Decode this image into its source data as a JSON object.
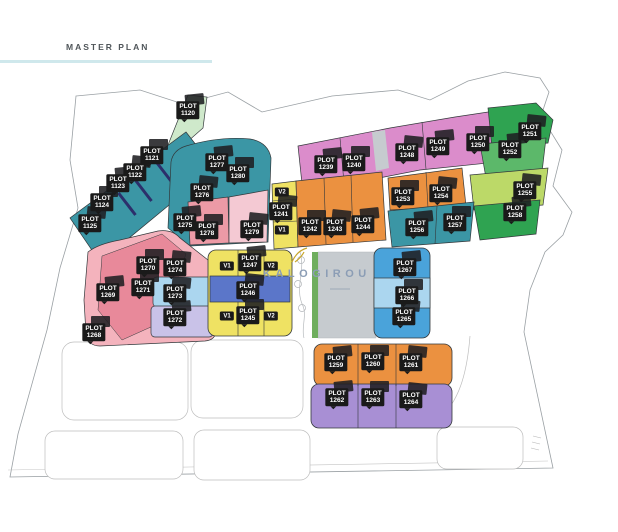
{
  "title": "MASTER PLAN",
  "brand": {
    "name": "KALOGIROU"
  },
  "colors": {
    "teal": "#3b96a5",
    "navyStripe": "#2c2f6b",
    "lightGreen": "#cfe9cb",
    "magenta": "#db8ccb",
    "pinkLight": "#f4c9d3",
    "pinkRose": "#ec9aa6",
    "pinkPale": "#f4b3bd",
    "pinkDeep": "#e8899a",
    "orange": "#eb9140",
    "yellow": "#efe263",
    "green": "#2fa351",
    "midGreen": "#5cb86a",
    "yellowGreen": "#bcd968",
    "greenStrip": "#6fae5e",
    "blue": "#5b76c9",
    "skyBlue": "#4aa3da",
    "paleBlue": "#abd6ef",
    "lavender": "#c9c2e8",
    "purple": "#a88fd4",
    "roadGray": "#c6cbcf",
    "gold": "#c8a62b",
    "brandText": "#8b9db5",
    "titleRule": "#cfe8ec",
    "labelBg": "#1a1a1a",
    "labelText": "#ffffff"
  },
  "plots": [
    {
      "kind": "plot",
      "label": "PLOT",
      "number": "1120",
      "x": 188,
      "y": 110,
      "area_color": "#cfe9cb"
    },
    {
      "kind": "plot",
      "label": "PLOT",
      "number": "1121",
      "x": 152,
      "y": 155,
      "area_color": "#3b96a5"
    },
    {
      "kind": "plot",
      "label": "PLOT",
      "number": "1122",
      "x": 135,
      "y": 172,
      "area_color": "#3b96a5"
    },
    {
      "kind": "plot",
      "label": "PLOT",
      "number": "1123",
      "x": 118,
      "y": 183,
      "area_color": "#3b96a5"
    },
    {
      "kind": "plot",
      "label": "PLOT",
      "number": "1124",
      "x": 102,
      "y": 202,
      "area_color": "#3b96a5"
    },
    {
      "kind": "plot",
      "label": "PLOT",
      "number": "1125",
      "x": 90,
      "y": 223,
      "area_color": "#3b96a5"
    },
    {
      "kind": "plot",
      "label": "PLOT",
      "number": "1277",
      "x": 217,
      "y": 162,
      "area_color": "#3b96a5"
    },
    {
      "kind": "plot",
      "label": "PLOT",
      "number": "1280",
      "x": 238,
      "y": 173,
      "area_color": "#3b96a5"
    },
    {
      "kind": "plot",
      "label": "PLOT",
      "number": "1276",
      "x": 202,
      "y": 192,
      "area_color": "#3b96a5"
    },
    {
      "kind": "plot",
      "label": "PLOT",
      "number": "1275",
      "x": 185,
      "y": 222,
      "area_color": "#3b96a5"
    },
    {
      "kind": "plot",
      "label": "PLOT",
      "number": "1278",
      "x": 207,
      "y": 230,
      "area_color": "#ec9aa6"
    },
    {
      "kind": "plot",
      "label": "PLOT",
      "number": "1279",
      "x": 252,
      "y": 229,
      "area_color": "#f4c9d3"
    },
    {
      "kind": "plot",
      "label": "PLOT",
      "number": "1239",
      "x": 326,
      "y": 164,
      "area_color": "#db8ccb"
    },
    {
      "kind": "plot",
      "label": "PLOT",
      "number": "1240",
      "x": 354,
      "y": 162,
      "area_color": "#db8ccb"
    },
    {
      "kind": "plot",
      "label": "PLOT",
      "number": "1248",
      "x": 407,
      "y": 152,
      "area_color": "#db8ccb"
    },
    {
      "kind": "plot",
      "label": "PLOT",
      "number": "1249",
      "x": 438,
      "y": 146,
      "area_color": "#db8ccb"
    },
    {
      "kind": "plot",
      "label": "PLOT",
      "number": "1250",
      "x": 478,
      "y": 142,
      "area_color": "#db8ccb"
    },
    {
      "kind": "plot",
      "label": "PLOT",
      "number": "1251",
      "x": 530,
      "y": 131,
      "area_color": "#2fa351"
    },
    {
      "kind": "plot",
      "label": "PLOT",
      "number": "1252",
      "x": 510,
      "y": 149,
      "area_color": "#5cb86a"
    },
    {
      "kind": "marker",
      "number": "V2",
      "x": 282,
      "y": 192,
      "area_color": "#efe263"
    },
    {
      "kind": "plot",
      "label": "PLOT",
      "number": "1241",
      "x": 281,
      "y": 211,
      "area_color": "#efe263"
    },
    {
      "kind": "marker",
      "number": "V1",
      "x": 282,
      "y": 230,
      "area_color": "#efe263"
    },
    {
      "kind": "plot",
      "label": "PLOT",
      "number": "1242",
      "x": 310,
      "y": 226,
      "area_color": "#eb9140"
    },
    {
      "kind": "plot",
      "label": "PLOT",
      "number": "1243",
      "x": 335,
      "y": 226,
      "area_color": "#eb9140"
    },
    {
      "kind": "plot",
      "label": "PLOT",
      "number": "1244",
      "x": 363,
      "y": 224,
      "area_color": "#eb9140"
    },
    {
      "kind": "plot",
      "label": "PLOT",
      "number": "1253",
      "x": 403,
      "y": 196,
      "area_color": "#eb9140"
    },
    {
      "kind": "plot",
      "label": "PLOT",
      "number": "1254",
      "x": 441,
      "y": 193,
      "area_color": "#eb9140"
    },
    {
      "kind": "plot",
      "label": "PLOT",
      "number": "1256",
      "x": 417,
      "y": 227,
      "area_color": "#3b96a5"
    },
    {
      "kind": "plot",
      "label": "PLOT",
      "number": "1257",
      "x": 455,
      "y": 222,
      "area_color": "#3b96a5"
    },
    {
      "kind": "plot",
      "label": "PLOT",
      "number": "1255",
      "x": 525,
      "y": 190,
      "area_color": "#bcd968"
    },
    {
      "kind": "plot",
      "label": "PLOT",
      "number": "1258",
      "x": 515,
      "y": 212,
      "area_color": "#2fa351"
    },
    {
      "kind": "plot",
      "label": "PLOT",
      "number": "1270",
      "x": 148,
      "y": 265,
      "area_color": "#ec9aa6"
    },
    {
      "kind": "plot",
      "label": "PLOT",
      "number": "1274",
      "x": 175,
      "y": 267,
      "area_color": "#f4c9d3"
    },
    {
      "kind": "plot",
      "label": "PLOT",
      "number": "1269",
      "x": 108,
      "y": 292,
      "area_color": "#ec9aa6"
    },
    {
      "kind": "plot",
      "label": "PLOT",
      "number": "1271",
      "x": 143,
      "y": 287,
      "area_color": "#ec9aa6"
    },
    {
      "kind": "plot",
      "label": "PLOT",
      "number": "1273",
      "x": 175,
      "y": 293,
      "area_color": "#abd6ef"
    },
    {
      "kind": "plot",
      "label": "PLOT",
      "number": "1272",
      "x": 175,
      "y": 317,
      "area_color": "#c9c2e8"
    },
    {
      "kind": "plot",
      "label": "PLOT",
      "number": "1268",
      "x": 94,
      "y": 332,
      "area_color": "#f4b3bd"
    },
    {
      "kind": "marker",
      "number": "V1",
      "x": 227,
      "y": 266,
      "area_color": "#efe263"
    },
    {
      "kind": "plot",
      "label": "PLOT",
      "number": "1247",
      "x": 250,
      "y": 262,
      "area_color": "#efe263"
    },
    {
      "kind": "marker",
      "number": "V2",
      "x": 271,
      "y": 266,
      "area_color": "#efe263"
    },
    {
      "kind": "plot",
      "label": "PLOT",
      "number": "1246",
      "x": 248,
      "y": 290,
      "area_color": "#5b76c9"
    },
    {
      "kind": "marker",
      "number": "V1",
      "x": 227,
      "y": 316,
      "area_color": "#efe263"
    },
    {
      "kind": "plot",
      "label": "PLOT",
      "number": "1245",
      "x": 248,
      "y": 315,
      "area_color": "#efe263"
    },
    {
      "kind": "marker",
      "number": "V2",
      "x": 271,
      "y": 316,
      "area_color": "#efe263"
    },
    {
      "kind": "plot",
      "label": "PLOT",
      "number": "1267",
      "x": 405,
      "y": 267,
      "area_color": "#4aa3da"
    },
    {
      "kind": "plot",
      "label": "PLOT",
      "number": "1266",
      "x": 407,
      "y": 295,
      "area_color": "#abd6ef"
    },
    {
      "kind": "plot",
      "label": "PLOT",
      "number": "1265",
      "x": 404,
      "y": 316,
      "area_color": "#4aa3da"
    },
    {
      "kind": "plot",
      "label": "PLOT",
      "number": "1259",
      "x": 336,
      "y": 362,
      "area_color": "#eb9140"
    },
    {
      "kind": "plot",
      "label": "PLOT",
      "number": "1260",
      "x": 373,
      "y": 361,
      "area_color": "#eb9140"
    },
    {
      "kind": "plot",
      "label": "PLOT",
      "number": "1261",
      "x": 411,
      "y": 362,
      "area_color": "#eb9140"
    },
    {
      "kind": "plot",
      "label": "PLOT",
      "number": "1262",
      "x": 337,
      "y": 397,
      "area_color": "#a88fd4"
    },
    {
      "kind": "plot",
      "label": "PLOT",
      "number": "1263",
      "x": 373,
      "y": 397,
      "area_color": "#a88fd4"
    },
    {
      "kind": "plot",
      "label": "PLOT",
      "number": "1264",
      "x": 411,
      "y": 399,
      "area_color": "#a88fd4"
    }
  ]
}
